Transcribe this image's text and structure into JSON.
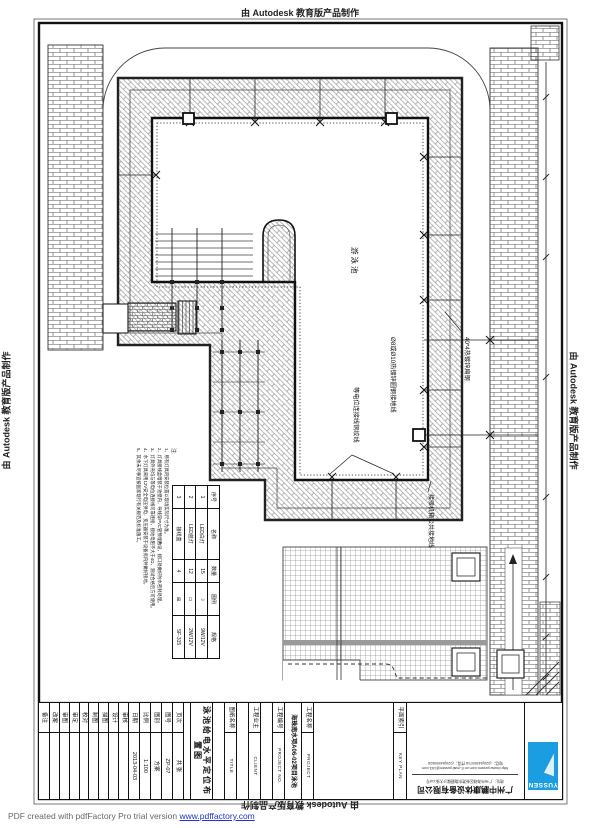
{
  "banners": {
    "top": "由 Autodesk 教育版产品制作",
    "bottom": "由 Autodesk 教育版产品制作",
    "left": "由 Autodesk 教育版产品制作",
    "right": "由 Autodesk 教育版产品制作"
  },
  "footer": {
    "text": "PDF created with pdfFactory Pro trial version ",
    "link": "www.pdffactory.com"
  },
  "plan": {
    "pool_label": "游泳池",
    "annotations": {
      "a1": "Ø8或Ø10热镀锌圆钢接地线",
      "a2": "40*4热镀锌扁钢",
      "a3": "等电位连接线铜绞线",
      "a4": "接驳机箱公共接地线"
    },
    "notes": {
      "label": "注:",
      "items": [
        "1、所有灯具的安装位置以现场实际尺寸为准。",
        "2、灯具接线盒暗装于池壁内，导线穿PVC管预埋敷设，接口处做好防水密封处理。",
        "3、灯具外壳均与等电位连接线可靠连接，接地电阻不大于4Ω，测试合格后方可使用。",
        "4、水下灯具采用12V安全电压供电，变压器安装于设备房内并做好接地。",
        "5、其余未尽事宜按国家现行有关规范及标准施工。"
      ]
    }
  },
  "fixture_table": {
    "headers": [
      "序号",
      "名称",
      "数量",
      "图例",
      "规格"
    ],
    "rows": [
      {
        "no": "1",
        "name": "LED白灯",
        "qty": "15",
        "symbol": "☽",
        "spec": "9W/12V"
      },
      {
        "no": "2",
        "name": "LED蓝灯",
        "qty": "12",
        "symbol": "▭",
        "spec": "2W/12V"
      },
      {
        "no": "3",
        "name": "接线盒",
        "qty": "4",
        "symbol": "⊞",
        "spec": "SF-315"
      }
    ]
  },
  "title_block": {
    "sign_cols": [
      "审核",
      "设计",
      "描图",
      "制图",
      "校对",
      "审定",
      "审图",
      "改案",
      "备注"
    ],
    "info": [
      {
        "label": "页次",
        "value": "共 张"
      },
      {
        "label": "图号",
        "value": "ZP-07"
      },
      {
        "label": "图别",
        "value": "方案"
      },
      {
        "label": "比例",
        "value": "1:100"
      },
      {
        "label": "日期",
        "value": "2013-04-03"
      }
    ],
    "drawing_title": "泳池给电水平定位布置图",
    "sheet_label": "图纸名称",
    "sheet_en": "TITLE",
    "client_label": "工程业主",
    "client_en": "CLIENT",
    "projno_label": "工程编号",
    "projno_en": "PROJECT NO.",
    "project_name": "海珠南水项A06-02项目泳池",
    "project_label": "工程名称",
    "project_en": "PROJECT",
    "keyplan_label": "平面索引",
    "keyplan_en": "KEY PLAN",
    "company": {
      "name": "广州中鹏康体设备有限公司",
      "address": "地址：广州市海珠区新港东路磨碟沙大街118号",
      "url_line": "http://www.yussen.com.cn  E-mail:yussen@163.com",
      "phone_line": "电话：(020)84559718   传真：(020)84559628"
    },
    "logo_text": "YUSSEN"
  }
}
